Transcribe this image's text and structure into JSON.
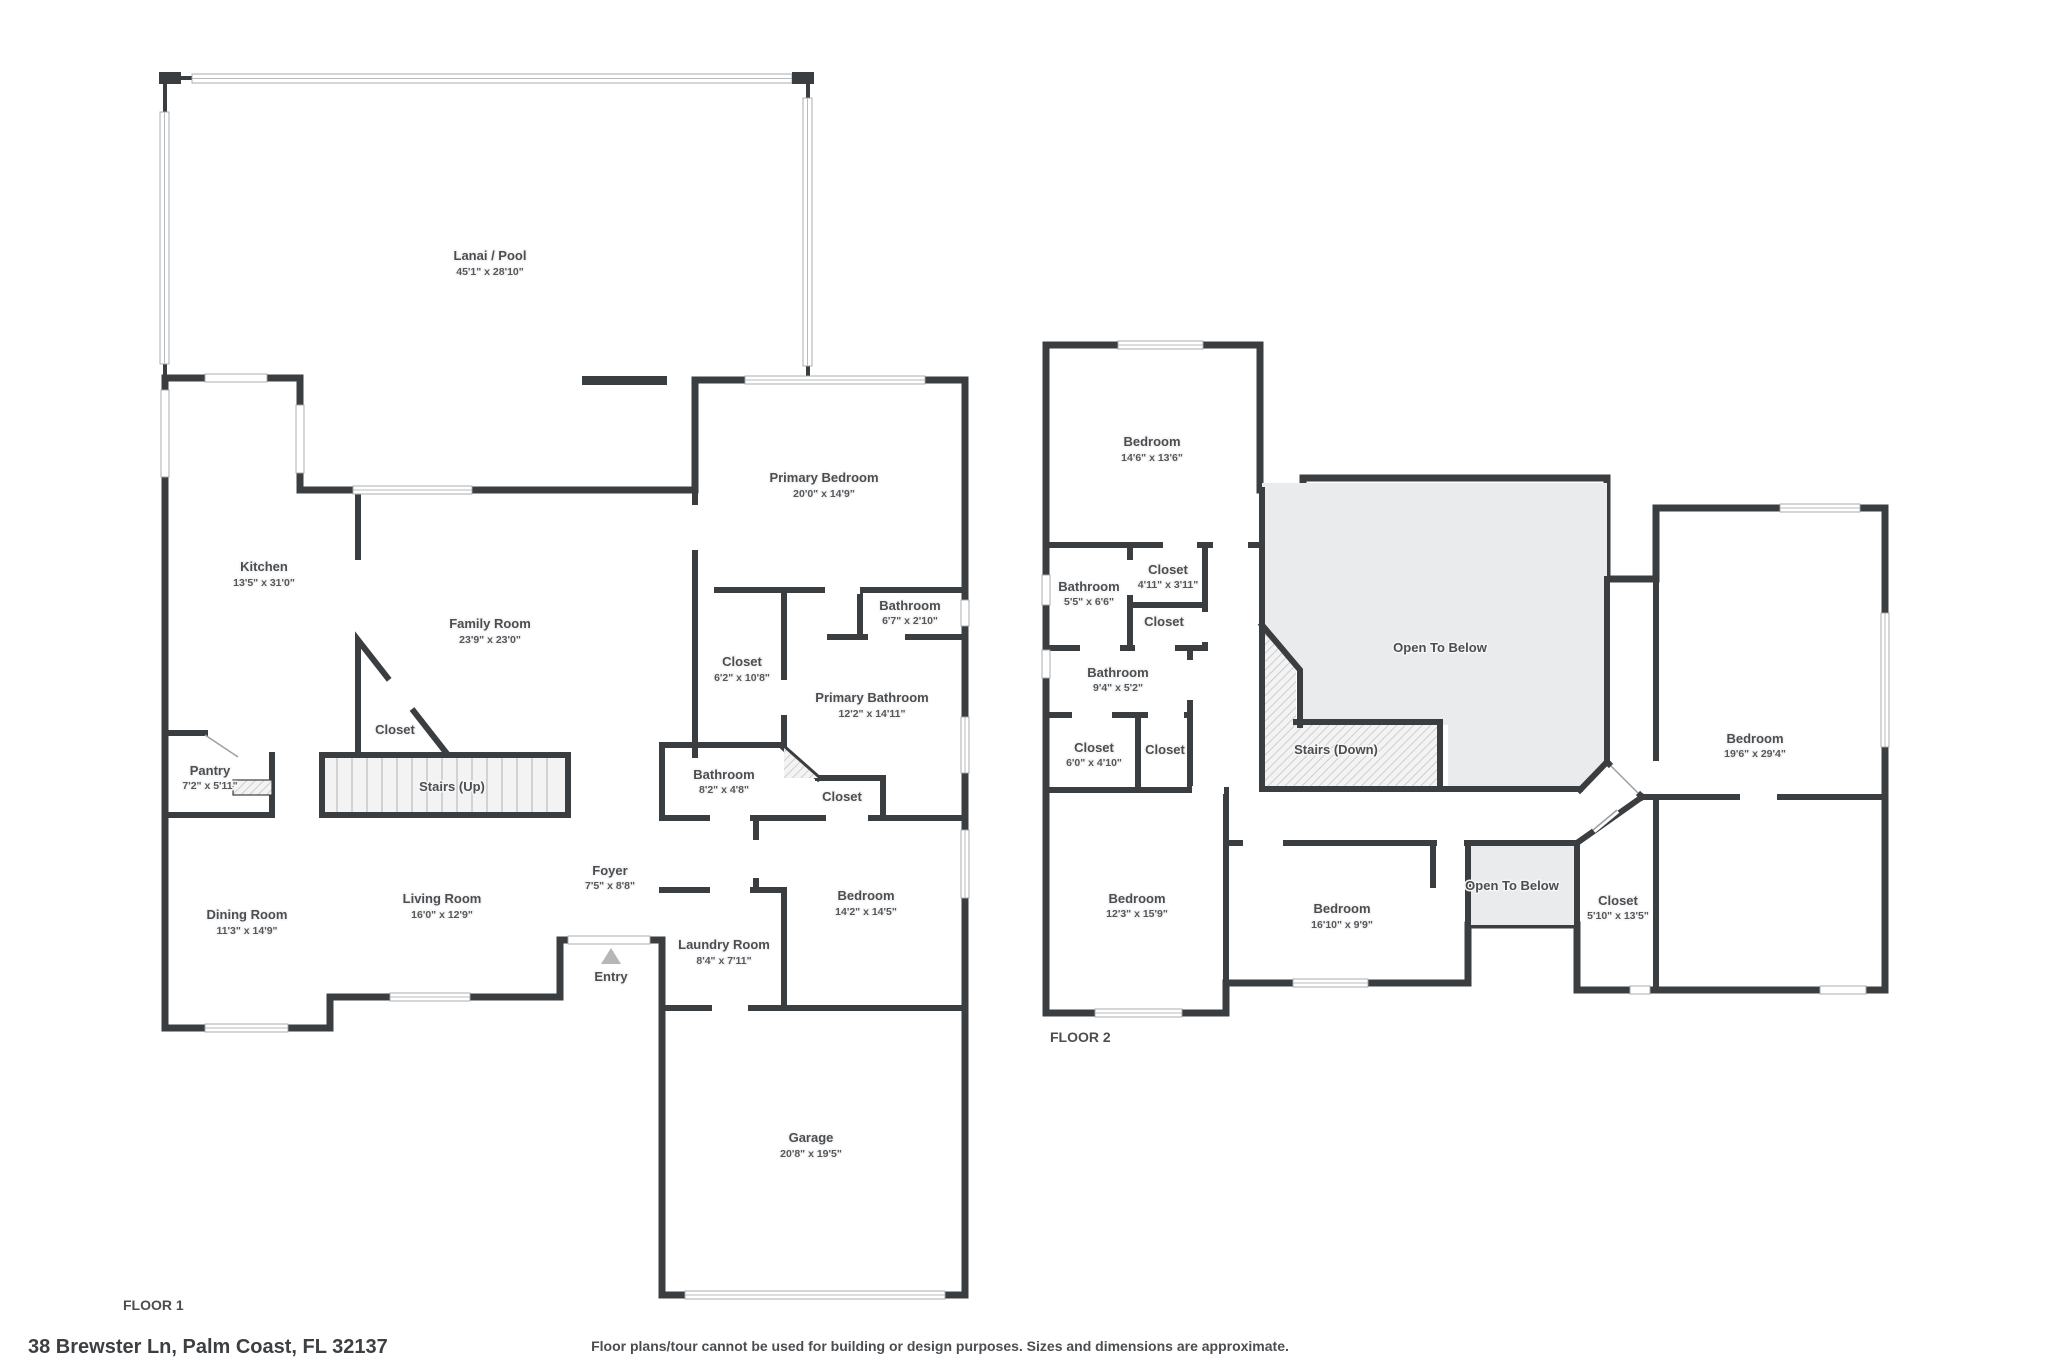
{
  "footer": {
    "address": "38 Brewster Ln, Palm Coast, FL 32137",
    "disclaimer": "Floor plans/tour cannot be used for building or design purposes. Sizes and dimensions are approximate."
  },
  "colors": {
    "wall": "#3b3e41",
    "room_fill": "#f5f5f6",
    "open_fill": "#eaebec",
    "text": "#4b4e51",
    "window_line": "#a2a6a9"
  },
  "floor1": {
    "label": "FLOOR 1",
    "rooms": [
      {
        "name": "Lanai / Pool",
        "dims": "45'1\" x 28'10\""
      },
      {
        "name": "Kitchen",
        "dims": "13'5\" x 31'0\""
      },
      {
        "name": "Family Room",
        "dims": "23'9\" x 23'0\""
      },
      {
        "name": "Primary Bedroom",
        "dims": "20'0\" x 14'9\""
      },
      {
        "name": "Bathroom",
        "dims": "6'7\" x 2'10\""
      },
      {
        "name": "Closet",
        "dims": "6'2\" x 10'8\""
      },
      {
        "name": "Primary Bathroom",
        "dims": "12'2\" x 14'11\""
      },
      {
        "name": "Closet",
        "dims": ""
      },
      {
        "name": "Pantry",
        "dims": "7'2\" x 5'11\""
      },
      {
        "name": "Stairs (Up)",
        "dims": ""
      },
      {
        "name": "Bathroom",
        "dims": "8'2\" x 4'8\""
      },
      {
        "name": "Closet",
        "dims": ""
      },
      {
        "name": "Foyer",
        "dims": "7'5\" x 8'8\""
      },
      {
        "name": "Dining Room",
        "dims": "11'3\" x 14'9\""
      },
      {
        "name": "Living Room",
        "dims": "16'0\" x 12'9\""
      },
      {
        "name": "Entry",
        "dims": ""
      },
      {
        "name": "Laundry Room",
        "dims": "8'4\" x 7'11\""
      },
      {
        "name": "Bedroom",
        "dims": "14'2\" x 14'5\""
      },
      {
        "name": "Garage",
        "dims": "20'8\" x 19'5\""
      }
    ]
  },
  "floor2": {
    "label": "FLOOR 2",
    "rooms": [
      {
        "name": "Bedroom",
        "dims": "14'6\" x 13'6\""
      },
      {
        "name": "Bathroom",
        "dims": "5'5\" x 6'6\""
      },
      {
        "name": "Closet",
        "dims": "4'11\" x 3'11\""
      },
      {
        "name": "Closet",
        "dims": ""
      },
      {
        "name": "Bathroom",
        "dims": "9'4\" x 5'2\""
      },
      {
        "name": "Closet",
        "dims": "6'0\" x 4'10\""
      },
      {
        "name": "Closet",
        "dims": ""
      },
      {
        "name": "Open To Below",
        "dims": ""
      },
      {
        "name": "Stairs (Down)",
        "dims": ""
      },
      {
        "name": "Bedroom",
        "dims": "12'3\" x 15'9\""
      },
      {
        "name": "Bedroom",
        "dims": "16'10\" x 9'9\""
      },
      {
        "name": "Open To Below",
        "dims": ""
      },
      {
        "name": "Closet",
        "dims": "5'10\" x 13'5\""
      },
      {
        "name": "Bedroom",
        "dims": "19'6\" x 29'4\""
      }
    ]
  }
}
